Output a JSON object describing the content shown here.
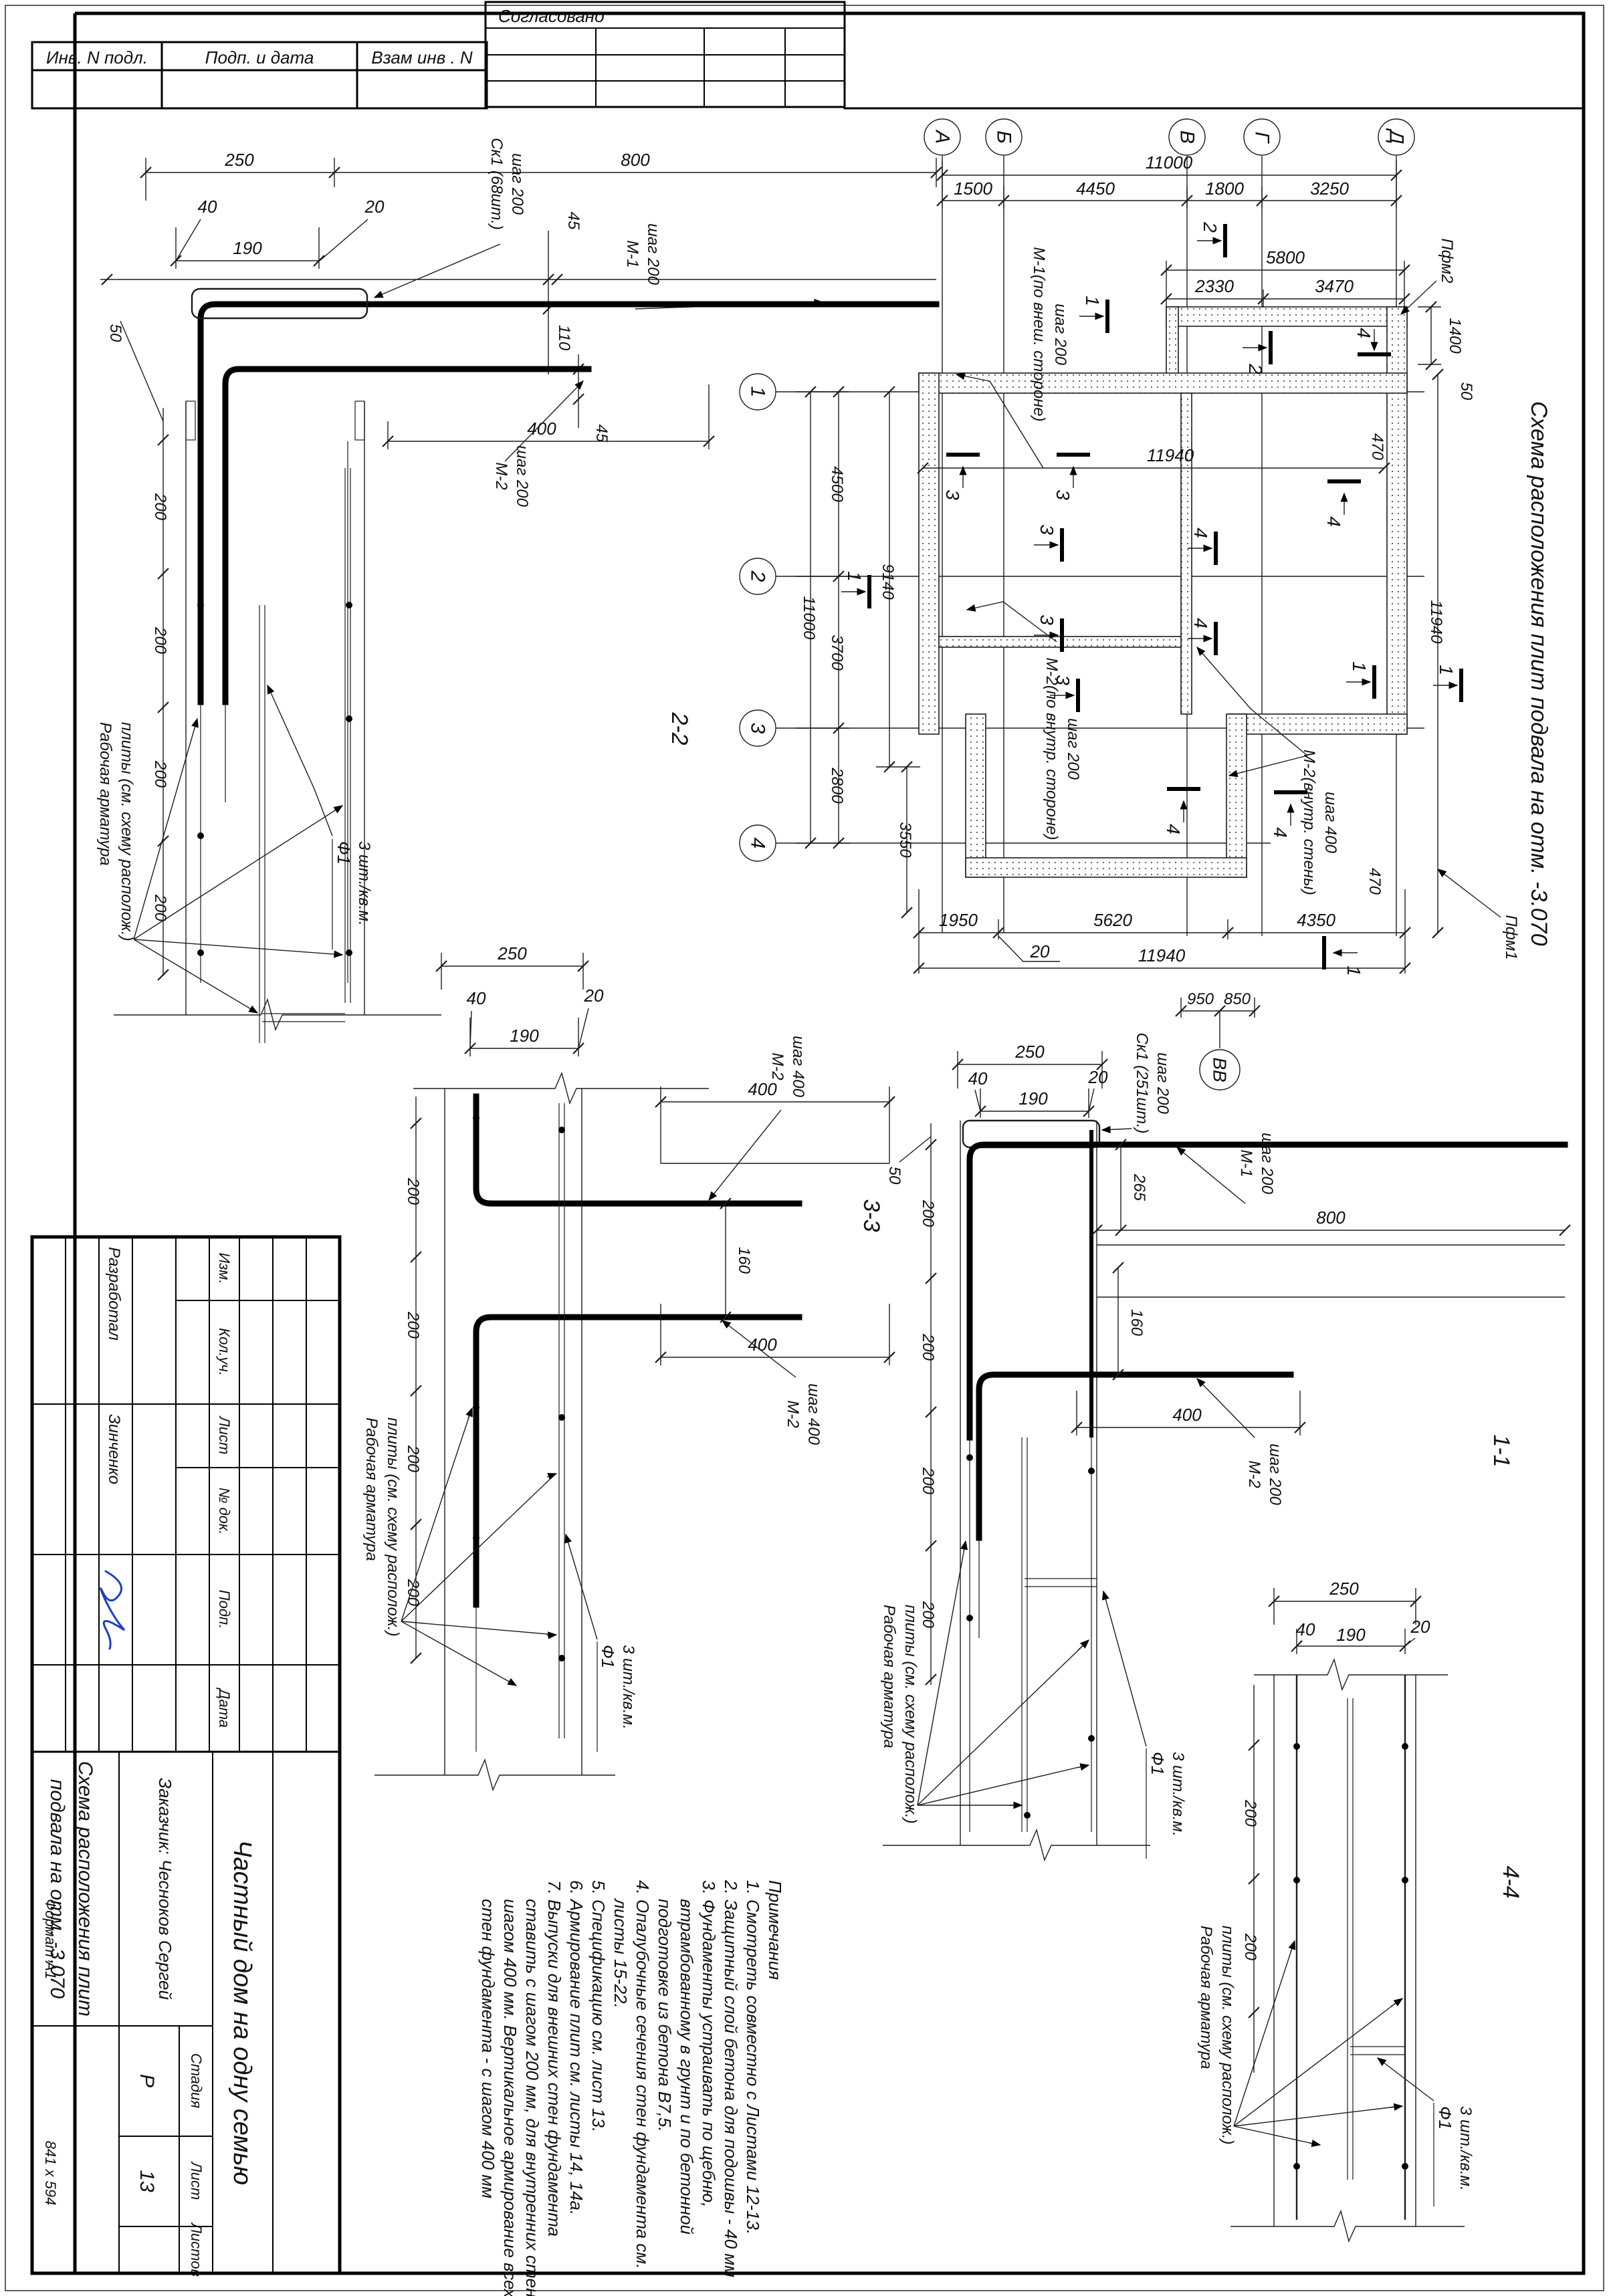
{
  "common": {
    "d200": "200",
    "d250": "250",
    "d190": "190",
    "d40": "40",
    "d20": "20",
    "d400": "400",
    "d800": "800",
    "d160": "160",
    "d50": "50",
    "d45": "45",
    "n1": "1",
    "n2": "2",
    "n3": "3",
    "n4": "4",
    "m1": "М-1",
    "m2": "М-2",
    "step200": "шаг 200",
    "step400": "шаг 400",
    "rab1": "Рабочая арматура",
    "rab2": "плиты (см. схему располож.)",
    "f1": "Ф1",
    "f1qty": "3 шт./кв.м."
  },
  "strips": {
    "c1": "Инв. N подл.",
    "c2": "Подп. и дата",
    "c3": "Взам инв . N"
  },
  "approve": {
    "title": "Согласовано"
  },
  "margin": {
    "format": "Формат А1",
    "size": "841 х 594"
  },
  "plan": {
    "title": "Схема расположения плит подвала на отм. -3.070",
    "axes_cols": [
      "А",
      "Б",
      "В",
      "Г",
      "Д"
    ],
    "axes_rows": [
      "1",
      "2",
      "3",
      "4"
    ],
    "dims": {
      "top_total": "11000",
      "top_segs": [
        "1500",
        "4450",
        "1800",
        "3250"
      ],
      "top_inner": "5800",
      "top_inner_segs": [
        "2330",
        "3470"
      ],
      "right_top": "1400",
      "right_50": "50",
      "right_470": "470",
      "right_total": "11940",
      "left_total": "11000",
      "left_segs": [
        "4500",
        "3700",
        "2800"
      ],
      "left_inner": "9140",
      "left_inner2": "3550",
      "inner_total": "11940",
      "bottom_segs": [
        "1950",
        "5620",
        "4350"
      ],
      "bottom_callout": "20",
      "bottom_total": "11940",
      "bottom_sub": [
        "950",
        "850"
      ]
    },
    "labels": {
      "pfm2": "Пфм2",
      "pfm1": "Пфм1",
      "m1_ext_1": "М-1(по внеш. стороне)",
      "m1_ext_2": "шаг 200",
      "m2_int_1": "М-2(по внутр. стороне)",
      "m2_int_2": "шаг 200",
      "m2_wall_1": "М-2(внутр. стены)",
      "m2_wall_2": "шаг 400",
      "vv": "ВВ"
    }
  },
  "sections": {
    "s22": {
      "title": "2-2",
      "sk": "Ск1 (68шт.)",
      "d110": "110"
    },
    "s33": {
      "title": "3-3"
    },
    "s11": {
      "title": "1-1",
      "sk": "Ск1 (251шт.)",
      "d265": "265"
    },
    "s44": {
      "title": "4-4"
    }
  },
  "notes": {
    "lines": [
      "Примечания",
      "1. Смотреть совместно с Листами 12-13.",
      "2. Защитный слой бетона для подошвы - 40 мм",
      "3. Фундаменты устраивать по щебню,",
      "втрамбованному в грунт и по бетонной",
      "подготовке из бетона В7,5.",
      "4. Опалубочные сечения стен фундамента см.",
      "листы 15-22.",
      "5. Спецификацию см. лист 13.",
      "6. Армирование плит см. листы 14, 14а.",
      "7. Выпуски  для внешних стен фундамента",
      "ставить с шагом 200 мм, для внутренних стен с",
      "шагом 400 мм. Вертикальное армирование всех",
      "стен фундамента - с шагом 400 мм"
    ]
  },
  "titleblock": {
    "cols": [
      "Изм.",
      "Кол.уч.",
      "Лист",
      "№ док.",
      "Подп.",
      "Дата"
    ],
    "developed_label": "Разработал",
    "developed_name": "Зинченко",
    "project": "Частный дом на одну семью",
    "client": "Заказчик: Чесноков Сергей",
    "doc1": "Схема расположения плит",
    "doc2": "подвала на отм. -3,070",
    "stage_label": "Стадия",
    "sheet_label": "Лист",
    "sheets_label": "Листов",
    "stage": "Р",
    "sheet": "13",
    "sheets": ""
  }
}
